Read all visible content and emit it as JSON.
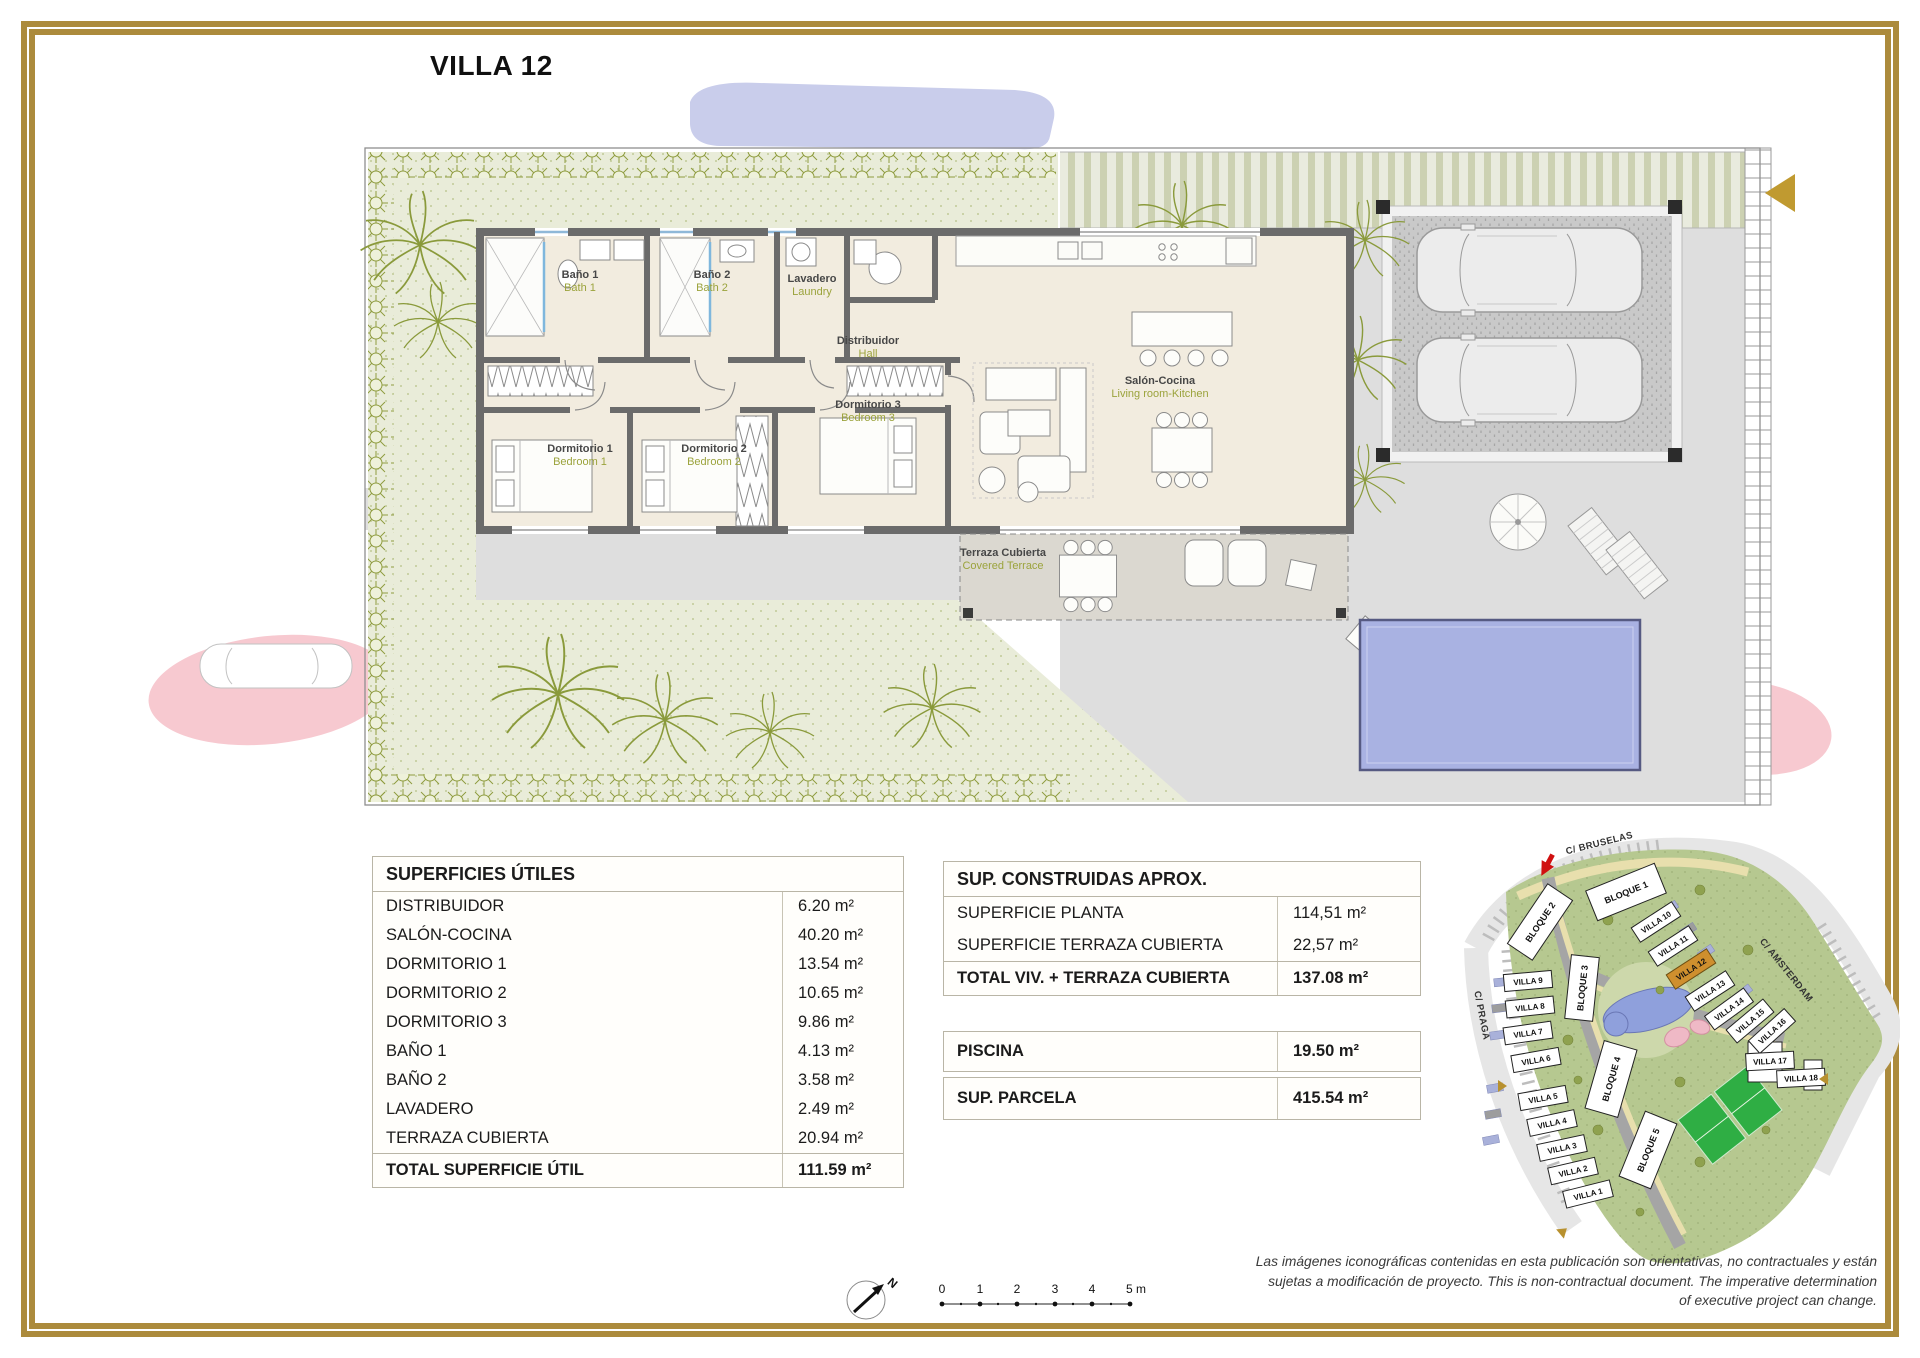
{
  "page": {
    "title": "VILLA 12"
  },
  "colors": {
    "gold": "#ac8b3c",
    "olive": "#9ba33c",
    "highlight": "#cf8f2e",
    "pool_blue": "#a9b2e2",
    "garden_green": "#e9ecd9",
    "pink": "#f7c9d0"
  },
  "plan": {
    "rooms": {
      "bath1": {
        "es": "Baño 1",
        "en": "Bath 1"
      },
      "bath2": {
        "es": "Baño 2",
        "en": "Bath 2"
      },
      "laundry": {
        "es": "Lavadero",
        "en": "Laundry"
      },
      "hall": {
        "es": "Distribuidor",
        "en": "Hall"
      },
      "bedroom1": {
        "es": "Dormitorio 1",
        "en": "Bedroom 1"
      },
      "bedroom2": {
        "es": "Dormitorio 2",
        "en": "Bedroom 2"
      },
      "bedroom3": {
        "es": "Dormitorio 3",
        "en": "Bedroom 3"
      },
      "living": {
        "es": "Salón-Cocina",
        "en": "Living room-Kitchen"
      },
      "terrace": {
        "es": "Terraza Cubierta",
        "en": "Covered Terrace"
      }
    }
  },
  "tables": {
    "useful": {
      "title": "SUPERFICIES ÚTILES",
      "rows": [
        {
          "label": "DISTRIBUIDOR",
          "value": "6.20 m²"
        },
        {
          "label": "SALÓN-COCINA",
          "value": "40.20 m²"
        },
        {
          "label": "DORMITORIO 1",
          "value": "13.54 m²"
        },
        {
          "label": "DORMITORIO 2",
          "value": "10.65 m²"
        },
        {
          "label": "DORMITORIO 3",
          "value": "9.86 m²"
        },
        {
          "label": "BAÑO 1",
          "value": "4.13 m²"
        },
        {
          "label": "BAÑO 2",
          "value": "3.58 m²"
        },
        {
          "label": "LAVADERO",
          "value": "2.49 m²"
        },
        {
          "label": "TERRAZA CUBIERTA",
          "value": "20.94 m²"
        }
      ],
      "total": {
        "label": "TOTAL SUPERFICIE ÚTIL",
        "value": "111.59 m²"
      }
    },
    "built": {
      "title": "SUP. CONSTRUIDAS APROX.",
      "rows": [
        {
          "label": "SUPERFICIE PLANTA",
          "value": "114,51 m²"
        },
        {
          "label": "SUPERFICIE TERRAZA CUBIERTA",
          "value": "22,57 m²"
        }
      ],
      "total": {
        "label": "TOTAL VIV. + TERRAZA CUBIERTA",
        "value": "137.08 m²"
      }
    },
    "pool": {
      "label": "PISCINA",
      "value": "19.50 m²"
    },
    "plot": {
      "label": "SUP. PARCELA",
      "value": "415.54 m²"
    }
  },
  "sitemap": {
    "streets": [
      {
        "name": "C/ BRUSELAS"
      },
      {
        "name": "C/ AMSTERDAM"
      },
      {
        "name": "C/ PRAGA"
      }
    ],
    "blocks": [
      {
        "label": "BLOQUE 1"
      },
      {
        "label": "BLOQUE 2"
      },
      {
        "label": "BLOQUE 3"
      },
      {
        "label": "BLOQUE 4"
      },
      {
        "label": "BLOQUE 5"
      }
    ],
    "villas": [
      {
        "label": "VILLA 1"
      },
      {
        "label": "VILLA 2"
      },
      {
        "label": "VILLA 3"
      },
      {
        "label": "VILLA 4"
      },
      {
        "label": "VILLA 5"
      },
      {
        "label": "VILLA 6"
      },
      {
        "label": "VILLA 7"
      },
      {
        "label": "VILLA 8"
      },
      {
        "label": "VILLA 9"
      },
      {
        "label": "VILLA 10"
      },
      {
        "label": "VILLA 11"
      },
      {
        "label": "VILLA 12"
      },
      {
        "label": "VILLA 13"
      },
      {
        "label": "VILLA 14"
      },
      {
        "label": "VILLA 15"
      },
      {
        "label": "VILLA 16"
      },
      {
        "label": "VILLA 17"
      },
      {
        "label": "VILLA 18"
      }
    ],
    "highlighted": "VILLA 12"
  },
  "legend": {
    "north": "N",
    "scale_ticks": [
      "0",
      "1",
      "2",
      "3",
      "4",
      "5 m"
    ]
  },
  "disclaimer": "Las imágenes iconográficas contenidas en esta publicación son orientativas, no contractuales y están sujetas a modificación de proyecto. This is non-contractual document. The imperative determination of executive project can change."
}
